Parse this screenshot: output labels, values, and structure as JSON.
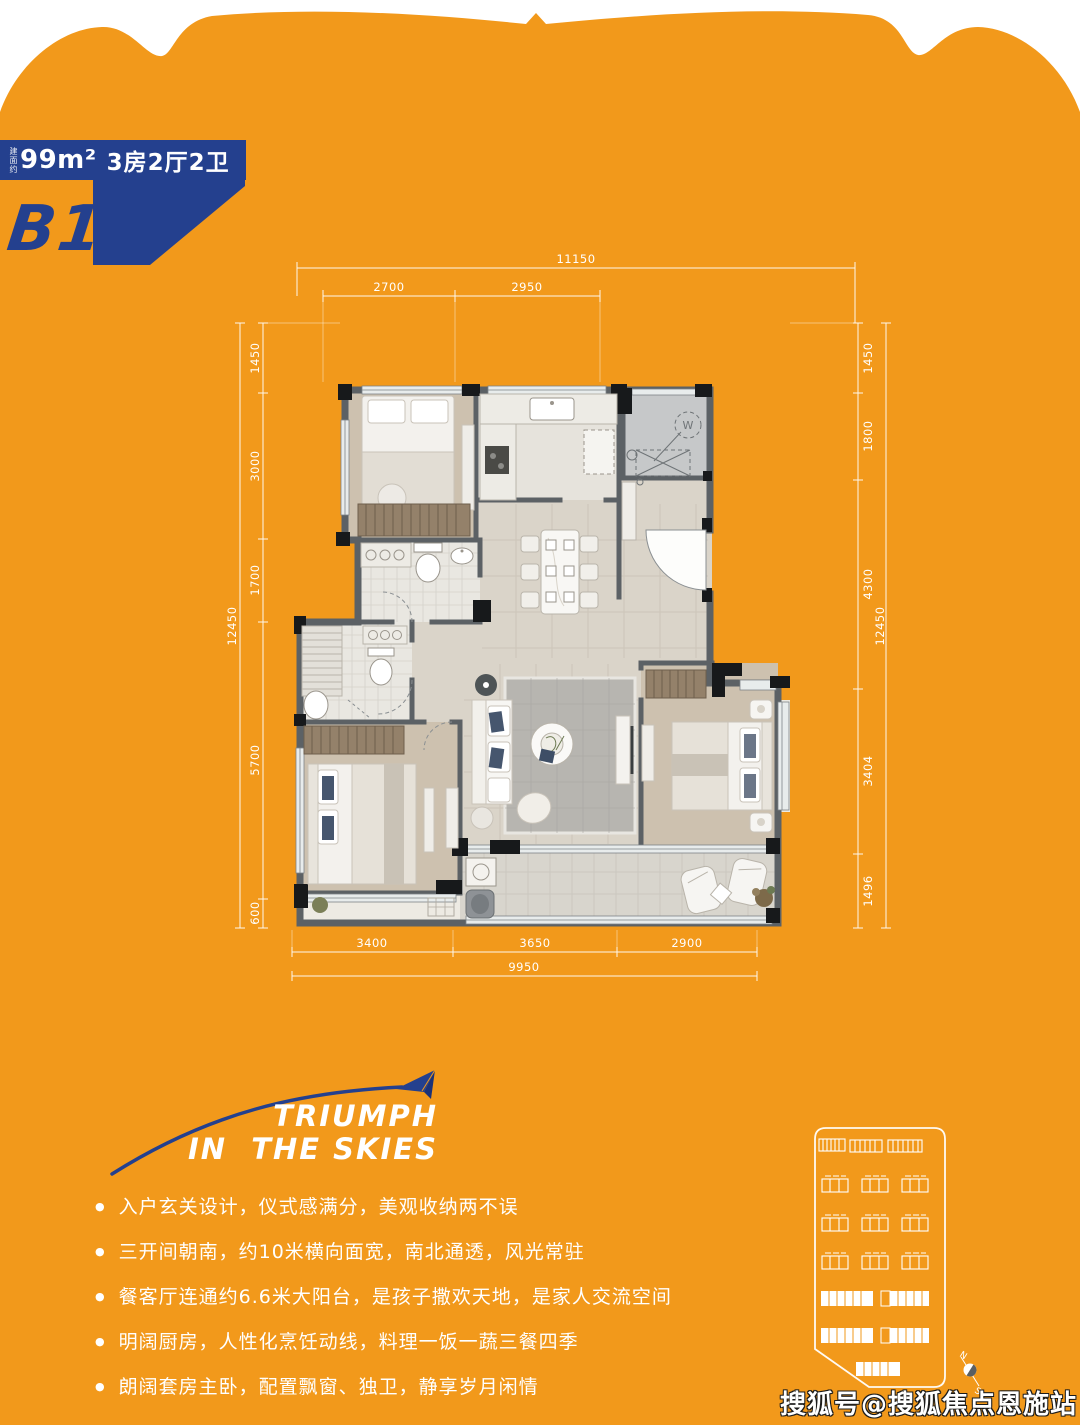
{
  "badge": {
    "area_prefix": "建面约",
    "area": "99m²",
    "layout": "3房2厅2卫",
    "unit": "B1"
  },
  "floorplan": {
    "washer_label": "W",
    "dims": {
      "top_overall": "11150",
      "top_segments": [
        "2700",
        "2950"
      ],
      "left_overall": "12450",
      "left_segments": [
        "1450",
        "3000",
        "1700",
        "5700",
        "600"
      ],
      "right_overall": "12450",
      "right_segments": [
        "1450",
        "1800",
        "4300",
        "3404",
        "1496"
      ],
      "bottom_overall": "9950",
      "bottom_segments": [
        "3400",
        "3650",
        "2900"
      ]
    }
  },
  "slogan": {
    "line1": "TRIUMPH",
    "line2": "IN  THE SKIES"
  },
  "features": [
    "入户玄关设计，仪式感满分，美观收纳两不误",
    "三开间朝南，约10米横向面宽，南北通透，风光常驻",
    "餐客厅连通约6.6米大阳台，是孩子撒欢天地，是家人交流空间",
    "明阔厨房，人性化烹饪动线，料理一饭一蔬三餐四季",
    "朗阔套房主卧，配置飘窗、独卫，静享岁月闲情"
  ],
  "siteplan": {
    "compass_n": "N",
    "compass_s": "S"
  },
  "watermark": "搜狐号@搜狐焦点恩施站",
  "colors": {
    "orange": "#F2991B",
    "blue": "#24408E"
  }
}
